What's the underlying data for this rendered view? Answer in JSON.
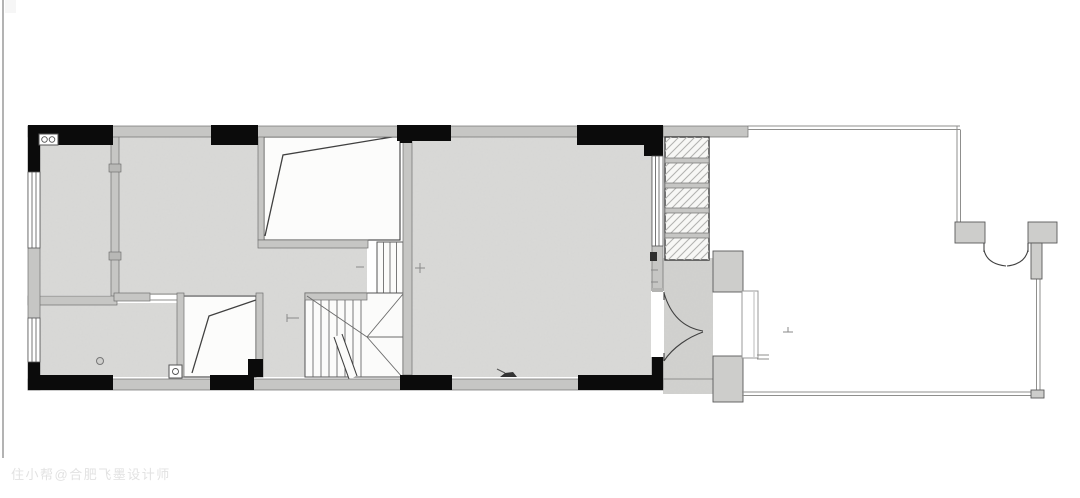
{
  "watermark": {
    "text": "住小帮@合肥飞墨设计师"
  },
  "colors": {
    "bg": "#ffffff",
    "wallGray": "#c6c6c4",
    "wallStroke": "#6f6f6f",
    "wallBlack": "#0b0b0b",
    "floor": "#dadad8",
    "floorDark": "#d2d2d0",
    "blockGray": "#cdcdcb",
    "white": "#fcfcfb",
    "line": "#404040",
    "thin": "#8f8f8d",
    "hatch": "#b3b3b1",
    "watermark": "#e2e2e2"
  },
  "symbols": {
    "entry_double_door": "double-leaf swing door, arcs opening into vestibule",
    "gate_double_door": "courtyard gate, two quarter-circle swings",
    "stairs": "U-shaped stair with winders and break line",
    "voids": "two open voids with roof-slope lines",
    "shelf_cabinet": "hatched 5-cell cabinet/shelf unit",
    "floor_drain_round": "round floor drain",
    "floor_drain_square": "square floor drain",
    "double_socket": "twin-circle fixture at top-left corner",
    "level_marks": "small + elevation marks"
  }
}
